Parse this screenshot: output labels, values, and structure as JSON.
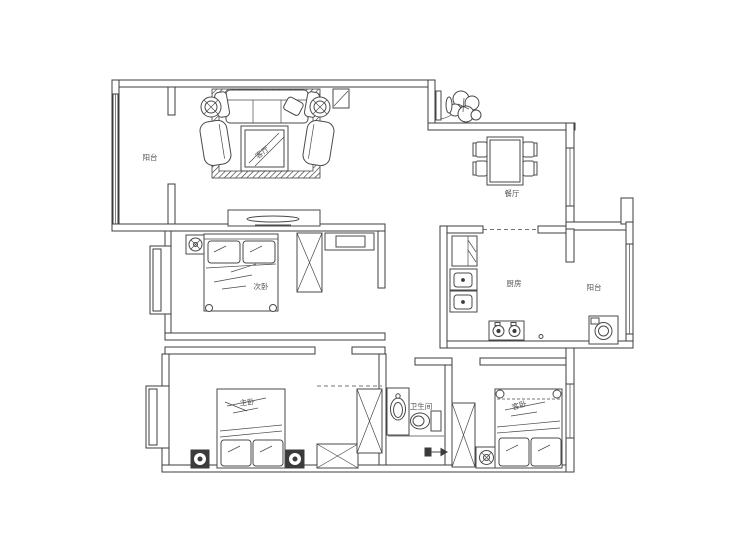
{
  "plan": {
    "background": "#ffffff",
    "line_color": "#3d3d3d",
    "label_color": "#555555",
    "labels": {
      "balcony_top": "阳台",
      "living": "客厅",
      "dining": "餐厅",
      "bedroom_second": "次卧",
      "kitchen": "厨房",
      "balcony_right": "阳台",
      "bedroom_master": "主卧",
      "bathroom": "卫生间",
      "bedroom_guest": "客卧"
    },
    "furniture": [
      "sofa",
      "armchair",
      "coffee-table",
      "tv-cabinet",
      "dining-table",
      "dining-chair",
      "potted-plant",
      "entry-door",
      "bed",
      "pillow",
      "nightstand",
      "wardrobe",
      "desk",
      "fridge",
      "kitchen-sink",
      "gas-stove",
      "washing-machine",
      "wash-basin",
      "toilet",
      "bay-window"
    ]
  }
}
